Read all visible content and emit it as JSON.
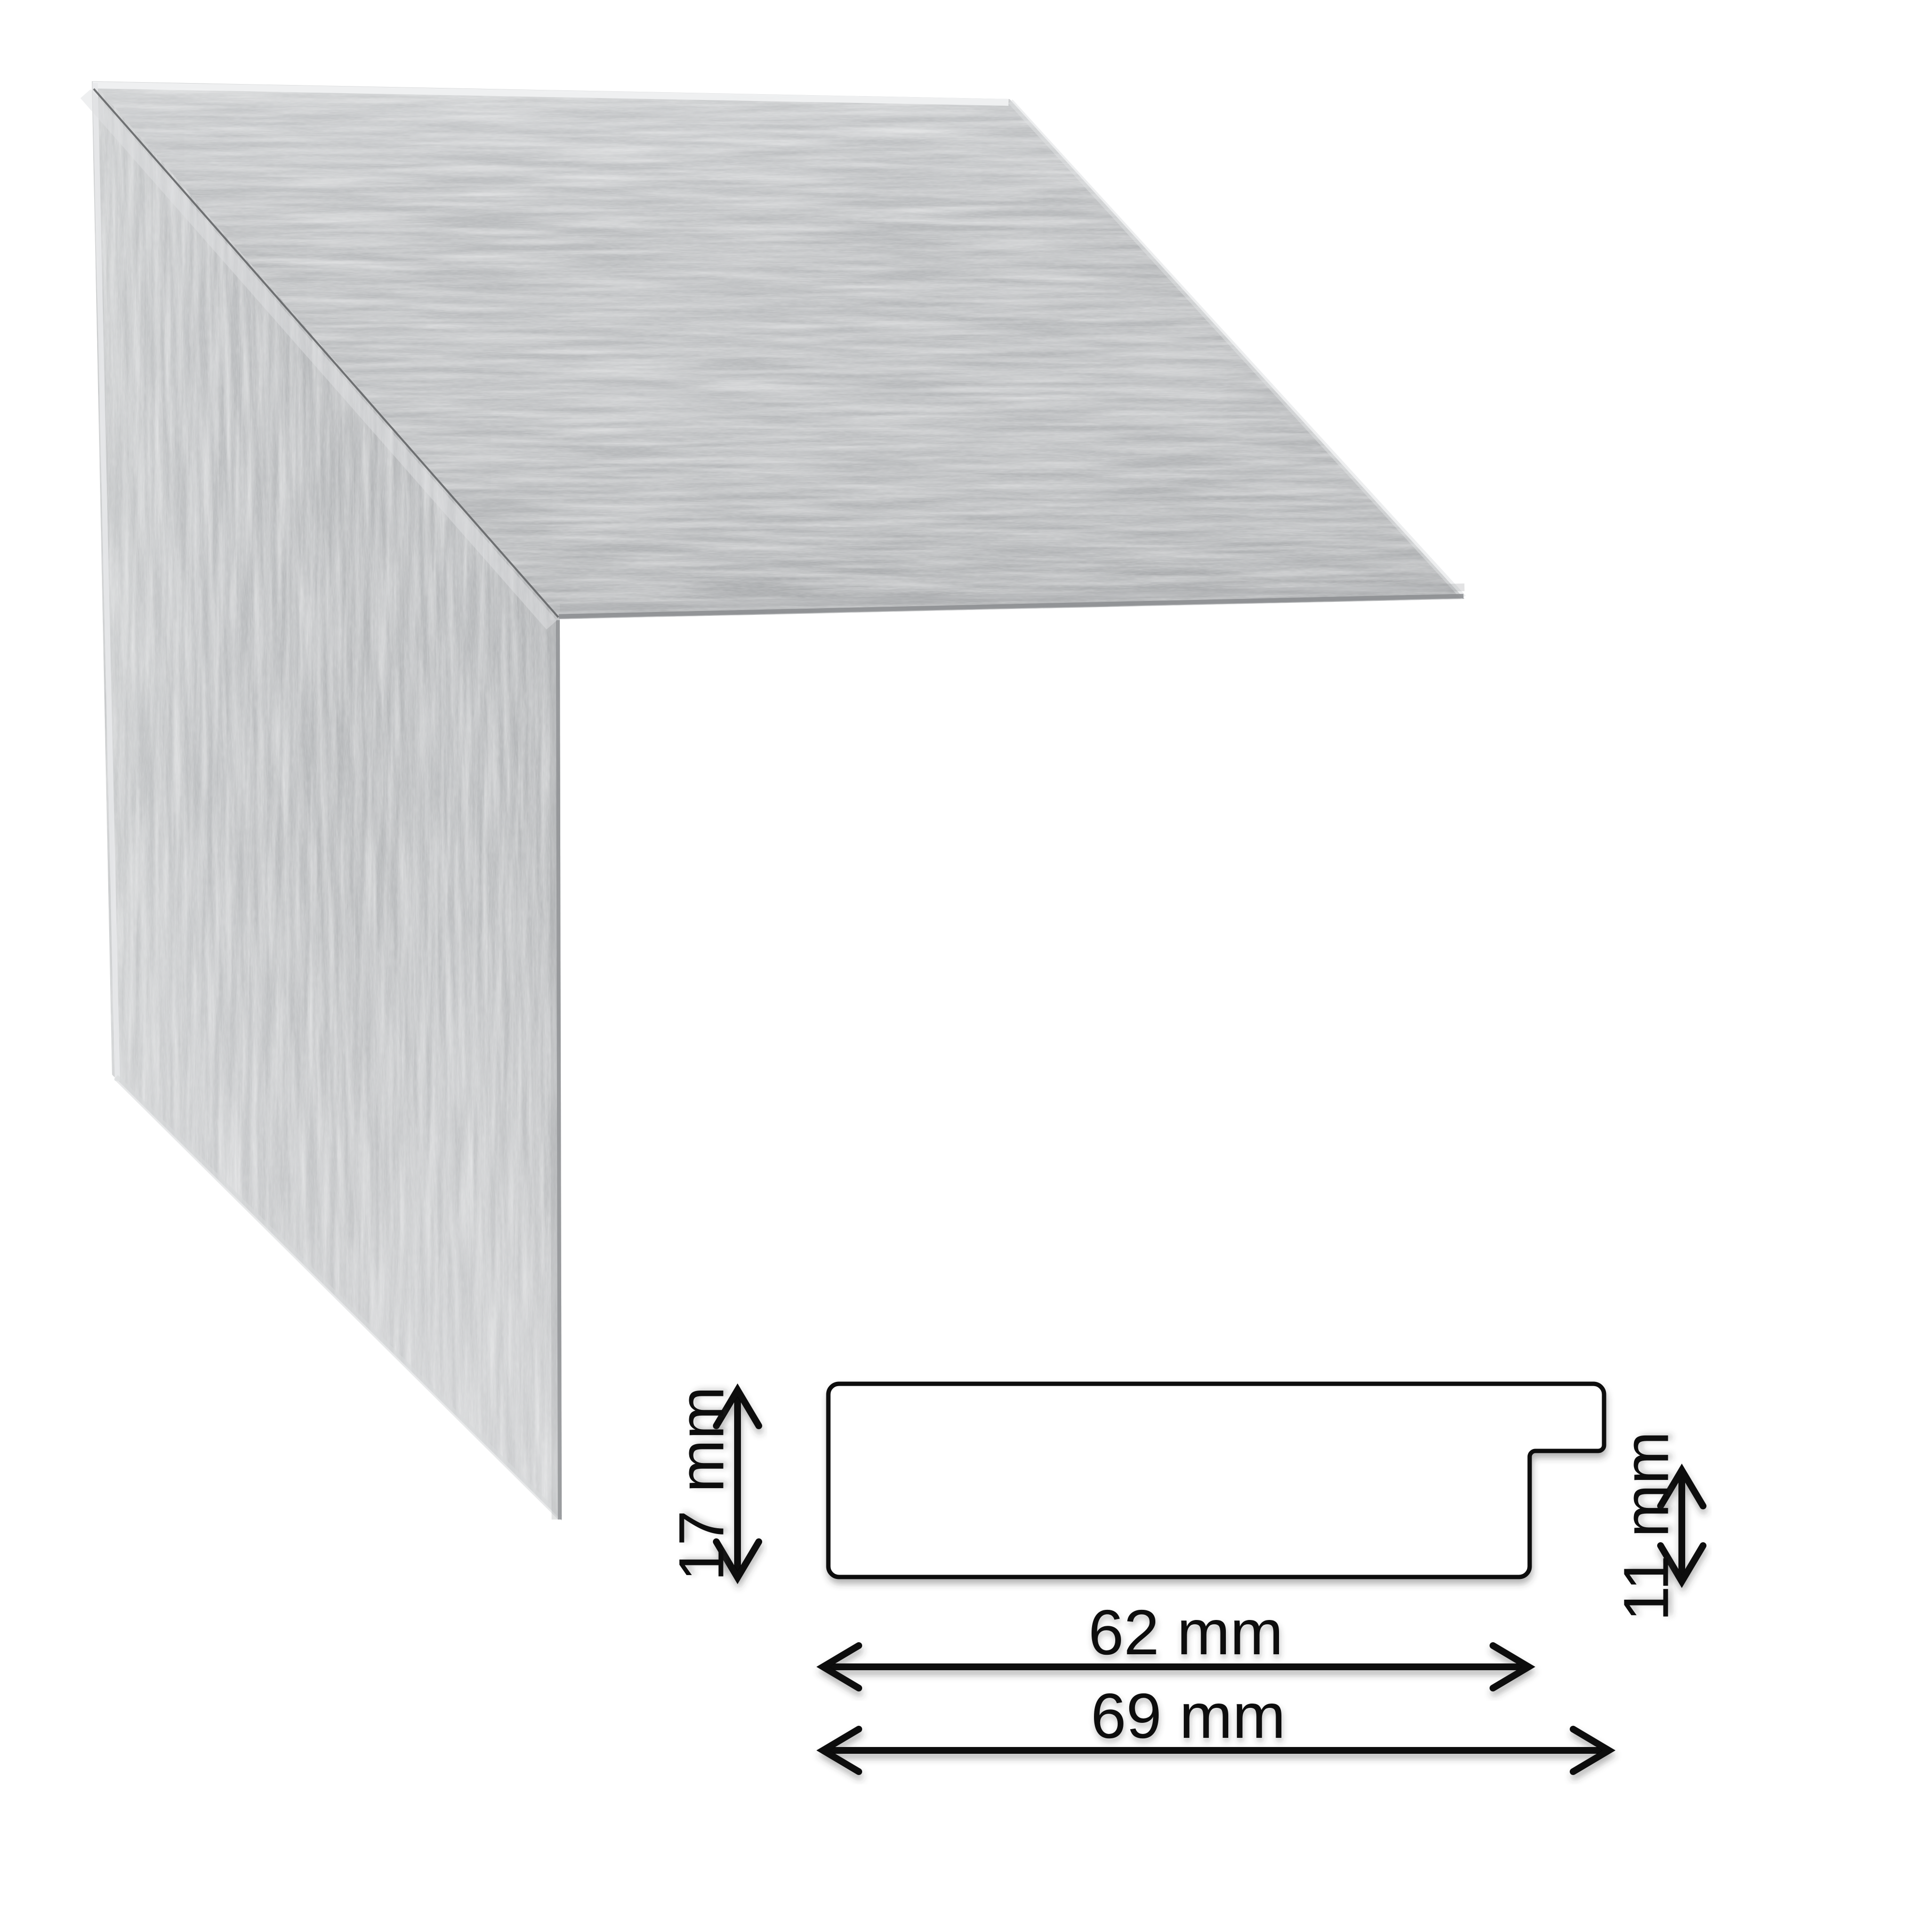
{
  "frame_sample": {
    "material_colors": {
      "base_gray": "#b8babc",
      "light_patch": "#dedfe1",
      "dark_patch": "#9fa1a4",
      "edge_highlight": "#f1f2f3",
      "edge_shadow": "#8b8d90",
      "miter_joint_line": "#646668"
    }
  },
  "drawing": {
    "line_color": "#000000",
    "labels": {
      "height": "17 mm",
      "rabbet_height": "11 mm",
      "face_width": "62 mm",
      "total_width": "69 mm"
    },
    "values_mm": {
      "height": 17,
      "rabbet_height": 11,
      "face_width": 62,
      "total_width": 69
    }
  }
}
